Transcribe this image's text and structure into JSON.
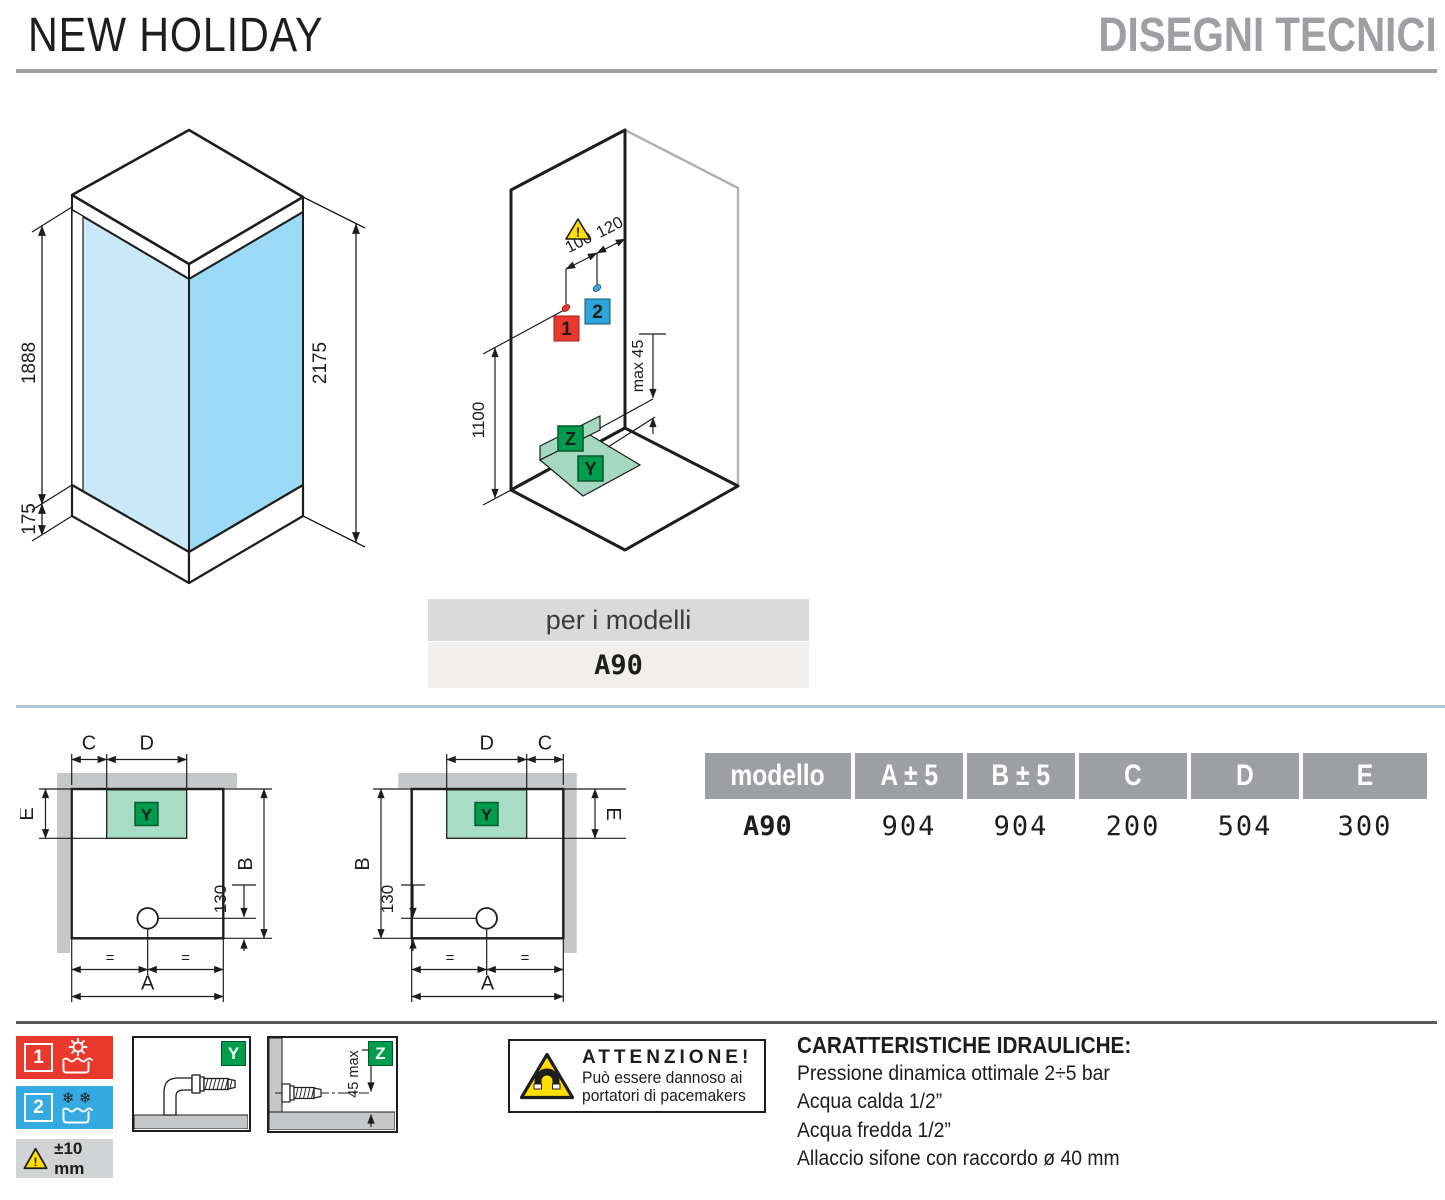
{
  "header": {
    "product": "NEW HOLIDAY",
    "section": "DISEGNI TECNICI"
  },
  "iso_cabin": {
    "glass_height": "1888",
    "tray_height": "175",
    "total_height": "2175"
  },
  "iso_install": {
    "hot_cold_spacing": "100",
    "corner_offset": "120",
    "supply_height": "1100",
    "wall_drain_max": "max 45",
    "hot_label": "1",
    "cold_label": "2",
    "floor_drain_label": "Y",
    "wall_drain_label": "Z"
  },
  "models_box": {
    "caption": "per i modelli",
    "model": "A90"
  },
  "plan": {
    "a": "A",
    "b": "B",
    "c": "C",
    "d": "D",
    "e": "E",
    "drain_offset": "130",
    "equal": "=",
    "drain_zone": "Y"
  },
  "table": {
    "columns": [
      "modello",
      "A ± 5",
      "B ± 5",
      "C",
      "D",
      "E"
    ],
    "row": {
      "model": "A90",
      "values": [
        "904",
        "904",
        "200",
        "504",
        "300"
      ]
    }
  },
  "legend": {
    "hot_number": "1",
    "cold_number": "2",
    "tolerance": "±10 mm",
    "floor_drain_label": "Y",
    "wall_drain_label": "Z",
    "wall_drain_dim": "45 max",
    "attention_title": "ATTENZIONE!",
    "attention_line1": "Può essere dannoso ai",
    "attention_line2": "portatori di pacemakers"
  },
  "hydraulics": {
    "title": "CARATTERISTICHE IDRAULICHE:",
    "lines": [
      "Pressione dinamica ottimale 2÷5 bar",
      "Acqua calda 1/2”",
      "Acqua fredda 1/2”",
      "Allaccio sifone con raccordo ø 40 mm"
    ]
  },
  "icons": {
    "hot": "sun-and-water-icon",
    "cold": "snowflakes-and-water-icon",
    "tolerance": "warning-triangle-icon",
    "attention": "magnet-warning-icon",
    "y_detail": "floor-drain-pipe-icon",
    "z_detail": "wall-drain-pipe-icon"
  },
  "colors": {
    "red": "#e8392c",
    "blue": "#35a9e1",
    "green": "#009c4d",
    "green_light": "#a9dcc4",
    "glass_light": "#c9e9f8",
    "glass_mid": "#9adaf6",
    "gray_header": "#9d9fa2",
    "gray_wall": "#c6c7c8",
    "separator_blue": "#b7c5d1",
    "separator_dark": "#58585a",
    "warning_yellow": "#ffde00"
  }
}
